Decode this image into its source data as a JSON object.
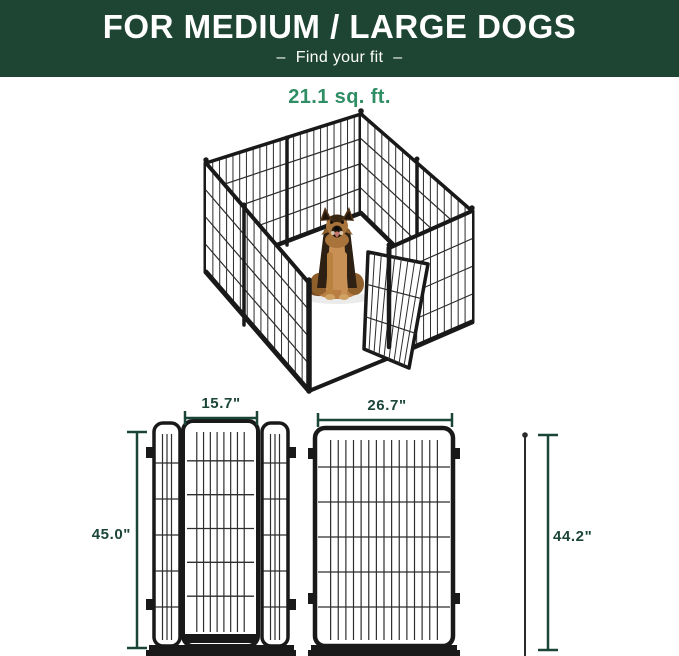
{
  "header": {
    "title": "FOR MEDIUM / LARGE DOGS",
    "subtitle": "Find your fit",
    "dash": "–"
  },
  "area": {
    "label": "21.1 sq. ft."
  },
  "dimensions": {
    "door_width": "15.7\"",
    "panel_width": "26.7\"",
    "door_panel_height": "45.0\"",
    "panel_height": "44.2\""
  },
  "illustration": {
    "description": "8-panel metal wire dog playpen with open door and German Shepherd sitting inside",
    "dog": "german-shepherd"
  },
  "colors": {
    "banner_bg": "#1e4433",
    "banner_text": "#ffffff",
    "accent_green": "#2f8e63",
    "dimension_green": "#1c4539",
    "panel_black": "#191919"
  }
}
